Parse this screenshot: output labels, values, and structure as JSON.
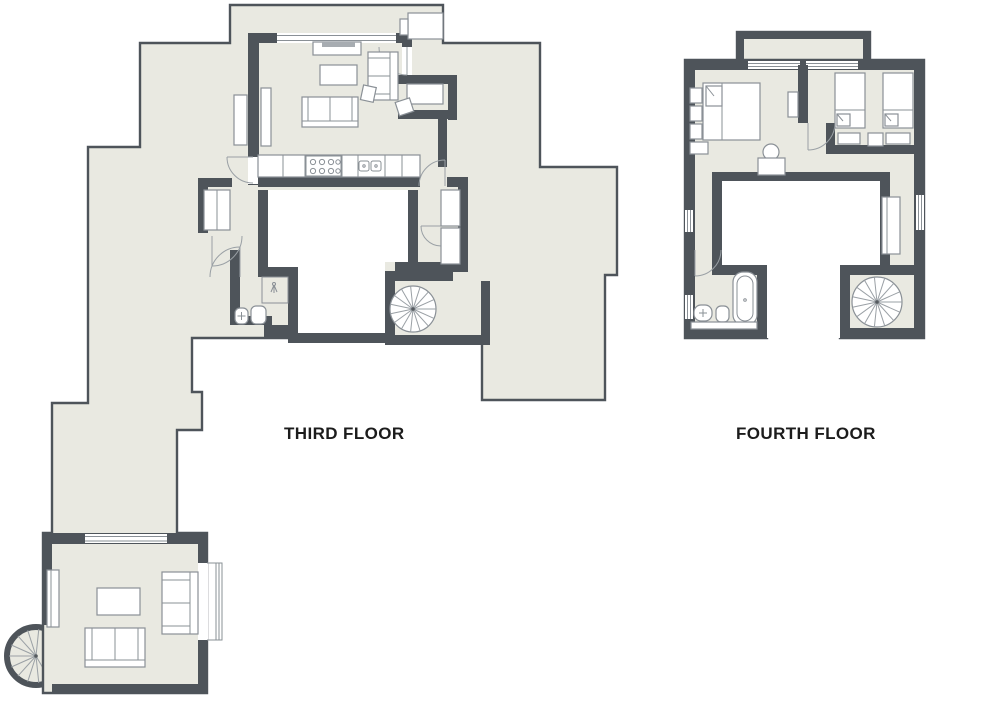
{
  "floors": {
    "third": {
      "label": "THIRD FLOOR"
    },
    "fourth": {
      "label": "FOURTH FLOOR"
    }
  },
  "colors": {
    "page_bg": "#ffffff",
    "floor_fill": "#e9e9e1",
    "wall": "#4e545a",
    "outline": "#5a6066",
    "furniture_stroke": "#8a9096",
    "void": "#ffffff",
    "label_text": "#1c1c1c"
  }
}
